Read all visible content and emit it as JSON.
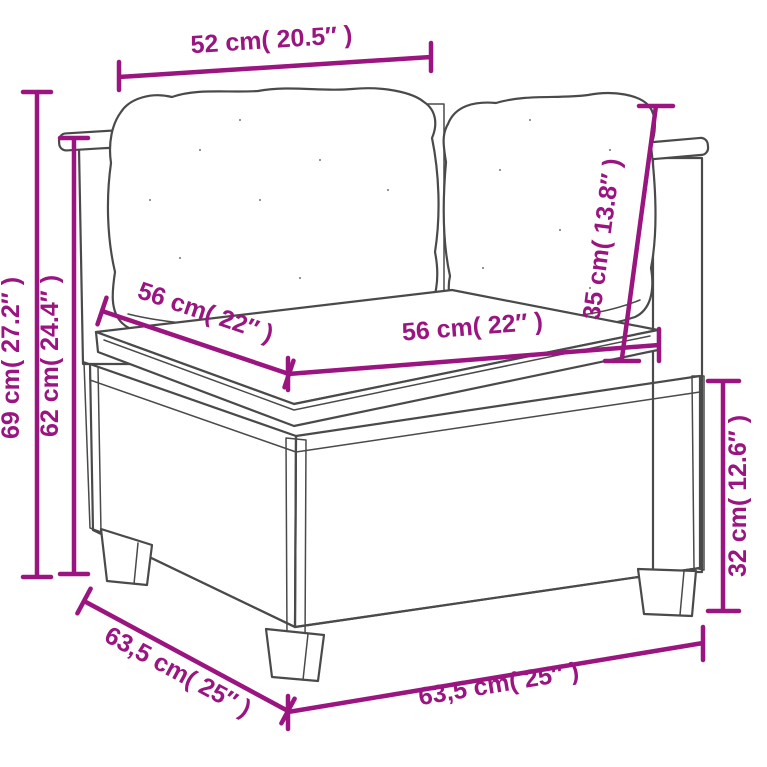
{
  "diagram": {
    "accent_color": "#9A1580",
    "sketch_color": "#4A4A4A",
    "dimensions": {
      "pillow_width_top": "52 cm( 20.5″ )",
      "overall_height": "69 cm( 27.2″ )",
      "backrest_height": "62 cm( 24.4″ )",
      "seat_depth": "56 cm( 22″ )",
      "seat_width": "56 cm( 22″ )",
      "back_cushion_height": "35 cm( 13.8″ )",
      "base_height": "32 cm( 12.6″ )",
      "base_depth": "63,5 cm( 25″ )",
      "base_width": "63,5 cm( 25″ )"
    }
  }
}
